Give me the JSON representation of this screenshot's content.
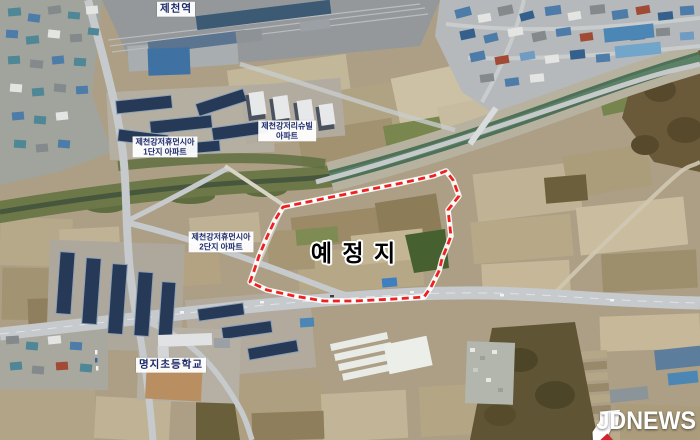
{
  "map": {
    "labels": {
      "station": "제천역",
      "apartment_complex_1": {
        "line1": "제천강저휴먼시아",
        "line2": "1단지 아파트"
      },
      "apartment_complex_2": {
        "line1": "제천강저리슈빌",
        "line2": "아파트"
      },
      "apartment_complex_3": {
        "line1": "제천강저휴먼시아",
        "line2": "2단지 아파트"
      },
      "planned_site": "예 정 지",
      "school": "명지초등학교"
    },
    "boundary_color": "#ee2020",
    "label_text_color": "#1c2a6b"
  },
  "watermark": {
    "press_name": "JDNEWS",
    "icon": "jdnews-flag-logo",
    "text_color": "#ffffff",
    "accent_red": "#d2232a",
    "accent_blue": "#1d3f94"
  }
}
